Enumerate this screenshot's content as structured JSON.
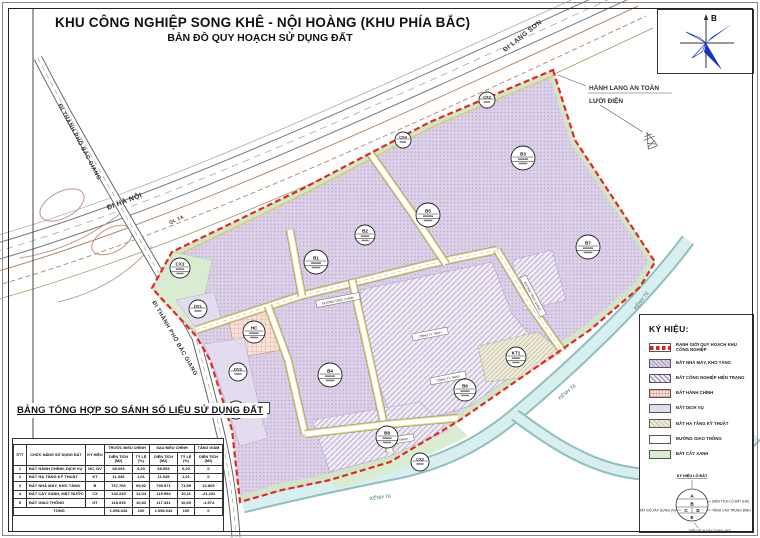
{
  "title": {
    "main": "KHU CÔNG NGHIỆP SONG KHÊ - NỘI HOÀNG (KHU PHÍA BẮC)",
    "sub": "BẢN ĐỒ QUY HOẠCH SỬ DỤNG ĐẤT"
  },
  "compass": {
    "north_label": "B"
  },
  "annotation": {
    "line1": "HÀNH LANG AN TOÀN",
    "line2": "LƯỚI ĐIỆN"
  },
  "map": {
    "road_labels": [
      {
        "text": "ĐI HÀ NỘI",
        "x": 108,
        "y": 210,
        "rot": -21,
        "size": 7
      },
      {
        "text": "QL 1A",
        "x": 170,
        "y": 224,
        "rot": -24,
        "size": 4.6
      },
      {
        "text": "ĐI LẠNG SƠN",
        "x": 505,
        "y": 52,
        "rot": -38,
        "size": 6.5
      },
      {
        "text": "ĐI THÀNH PHỐ BẮC GIANG",
        "x": 58,
        "y": 105,
        "rot": 62,
        "size": 5.8
      },
      {
        "text": "ĐI THÀNH PHỐ BẮC GIANG",
        "x": 152,
        "y": 302,
        "rot": 60,
        "size": 5.8
      }
    ],
    "canal_labels": [
      {
        "text": "KÊNH T6",
        "x": 636,
        "y": 310,
        "rot": -52
      },
      {
        "text": "KÊNH T6",
        "x": 560,
        "y": 400,
        "rot": -40
      },
      {
        "text": "KÊNH T6",
        "x": 370,
        "y": 500,
        "rot": -6
      }
    ],
    "label_boxes": [
      {
        "text": "ĐƯỜNG TRỤC CHÍNH",
        "x": 338,
        "y": 300,
        "rot": -11,
        "w": 44
      },
      {
        "text": "ĐƯỜNG TRỤC CHÍNH",
        "x": 533,
        "y": 296,
        "rot": 62,
        "w": 44
      },
      {
        "text": "CÔNG TY TNHH",
        "x": 430,
        "y": 334,
        "rot": -11,
        "w": 36
      },
      {
        "text": "CÔNG TY TNHH",
        "x": 448,
        "y": 378,
        "rot": -11,
        "w": 36
      },
      {
        "text": "CÔNG TY TNHH",
        "x": 396,
        "y": 440,
        "rot": -9,
        "w": 36
      }
    ],
    "parcels": [
      {
        "code": "B1",
        "x": 316,
        "y": 262,
        "r": 12
      },
      {
        "code": "B2",
        "x": 365,
        "y": 235,
        "r": 10
      },
      {
        "code": "B3",
        "x": 523,
        "y": 158,
        "r": 12
      },
      {
        "code": "B4",
        "x": 330,
        "y": 375,
        "r": 12
      },
      {
        "code": "B5",
        "x": 428,
        "y": 215,
        "r": 12
      },
      {
        "code": "B6",
        "x": 465,
        "y": 390,
        "r": 11
      },
      {
        "code": "B7",
        "x": 588,
        "y": 247,
        "r": 12
      },
      {
        "code": "B8",
        "x": 387,
        "y": 437,
        "r": 11
      },
      {
        "code": "KT1",
        "x": 516,
        "y": 357,
        "r": 10
      },
      {
        "code": "HC",
        "x": 254,
        "y": 332,
        "r": 11
      },
      {
        "code": "DV1",
        "x": 198,
        "y": 309,
        "r": 9
      },
      {
        "code": "DV2",
        "x": 238,
        "y": 372,
        "r": 9
      },
      {
        "code": "DV3",
        "x": 236,
        "y": 410,
        "r": 9
      },
      {
        "code": "CX1",
        "x": 180,
        "y": 268,
        "r": 10
      },
      {
        "code": "CX2",
        "x": 420,
        "y": 462,
        "r": 9
      },
      {
        "code": "CX3",
        "x": 487,
        "y": 100,
        "r": 8
      },
      {
        "code": "CX4",
        "x": 403,
        "y": 140,
        "r": 8
      },
      {
        "code": "P",
        "x": 264,
        "y": 408,
        "r": 6,
        "shape": "square"
      }
    ],
    "colors": {
      "boundary": "#e8271c",
      "factory_fill": "#dcd0e8",
      "existing_fill": "#efeaf5",
      "admin_fill": "#f7e2da",
      "service_fill": "#e2dcee",
      "technical_fill": "#eeead9",
      "green_fill": "#d9ecd2",
      "canal_fill": "#d8efef",
      "compass_blue": "#1535c8"
    }
  },
  "legend": {
    "title": "KÝ HIỆU:",
    "items": [
      {
        "type": "boundary",
        "label": "RANH GIỚI QUY HOẠCH KHU CÔNG NGHIỆP"
      },
      {
        "type": "factory",
        "label": "ĐẤT NHÀ MÁY, KHO TÀNG"
      },
      {
        "type": "existing",
        "label": "ĐẤT CÔNG NGHIỆP HIỆN TRẠNG"
      },
      {
        "type": "admin",
        "label": "ĐẤT HÀNH CHÍNH"
      },
      {
        "type": "service",
        "label": "ĐẤT DỊCH VỤ"
      },
      {
        "type": "technical",
        "label": "ĐẤT HẠ TẦNG KỸ THUẬT"
      },
      {
        "type": "road",
        "label": "ĐƯỜNG GIAO THÔNG"
      },
      {
        "type": "green",
        "label": "ĐẤT CÂY XANH"
      }
    ]
  },
  "plot_symbol": {
    "title": "KÝ HIỆU LÔ ĐẤT",
    "sections": [
      "A",
      "B",
      "C",
      "D",
      "E"
    ],
    "labels": {
      "area": "DIỆN TÍCH LÔ ĐẤT (HA)",
      "floors": "TẦNG CAO TRUNG BÌNH",
      "density": "MẬT ĐỘ XÂY DỰNG (%)",
      "built": "DIỆN TÍCH XÂY DỰNG (M2)"
    }
  },
  "table": {
    "title": "BẢNG TỔNG HỢP SO SÁNH SỐ LIỆU SỬ DỤNG ĐẤT",
    "col_headers": {
      "stt": "STT",
      "function": "CHỨC NĂNG SỬ DỤNG ĐẤT",
      "symbol": "KÝ HIỆU",
      "before": "TRƯỚC ĐIỀU CHỈNH",
      "after": "SAU ĐIỀU CHỈNH",
      "change": "TĂNG GIẢM",
      "area": "DIỆN TÍCH (M2)",
      "ratio": "TỶ LỆ (%)"
    },
    "rows": [
      [
        "1",
        "ĐẤT HÀNH CHÍNH, DỊCH VỤ",
        "HC, DV",
        "68.093",
        "6,20",
        "68.093",
        "6,20",
        "0"
      ],
      [
        "2",
        "ĐẤT HẠ TẦNG KỸ THUẬT",
        "KT",
        "11.045",
        "1,01",
        "11.045",
        "1,01",
        "0"
      ],
      [
        "3",
        "ĐẤT NHÀ MÁY, KHO TÀNG",
        "B",
        "767.766",
        "69,92",
        "790.571",
        "71,99",
        "22.805"
      ],
      [
        "4",
        "ĐẤT CÂY XANH, MẶT NƯỚC",
        "CX",
        "132.225",
        "12,04",
        "110.994",
        "10,11",
        "-21.231"
      ],
      [
        "5",
        "ĐẤT GIAO THÔNG",
        "GT",
        "118.915",
        "10,83",
        "117.341",
        "10,69",
        "-1.574"
      ]
    ],
    "total_row": [
      "TỔNG",
      "1.098.044",
      "100",
      "1.098.044",
      "100",
      "0"
    ]
  }
}
